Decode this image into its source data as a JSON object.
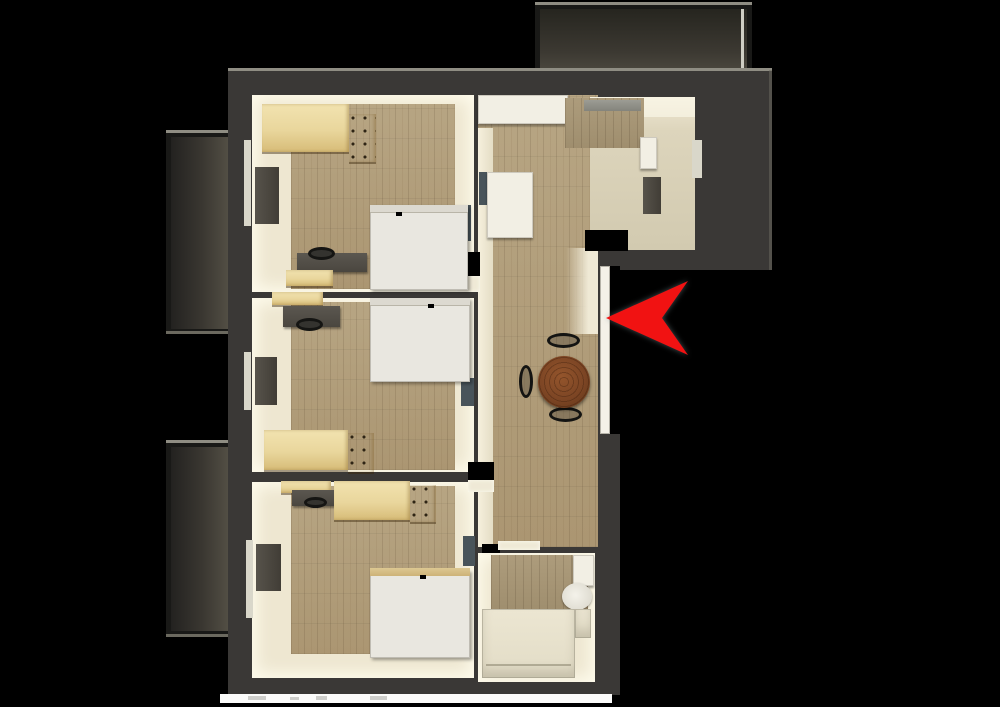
{
  "scene": {
    "view": "top-down-3d-floorplan-render",
    "background": "#000000",
    "marker": {
      "name": "entrance-arrow",
      "shape": "arrowhead-pointing-left",
      "color": "#f11212",
      "indicates": "entrance-door"
    }
  },
  "palette": {
    "wall": "#3a3836",
    "wall_edge_highlight": "#8f8d83",
    "floor_wood": "#b2a07e",
    "floor_cream": "#eee7d1",
    "floor_entry": "#d9d2b8",
    "pine_furniture": "#ecd9a2",
    "bed_white": "#e9e7e0",
    "desk_dark": "#57534b",
    "chair_black": "#141412",
    "table_brown": "#7c4524",
    "entrance_door_white": "#f4f1e8",
    "balcony_floor": "#46433b",
    "closed_door_slate": "#49545a"
  },
  "rooms": [
    {
      "id": "bedroom-top-left",
      "furniture": [
        "pine-wardrobe",
        "wall-panel-desk",
        "window",
        "white-bed",
        "desk",
        "chair",
        "pine-box"
      ]
    },
    {
      "id": "bedroom-middle-left",
      "furniture": [
        "pine-shelf",
        "desk",
        "chair",
        "white-bed",
        "wall-panel-desk",
        "window",
        "pine-wardrobe"
      ]
    },
    {
      "id": "bedroom-bottom-left",
      "furniture": [
        "pine-shelf",
        "desk",
        "chair",
        "pine-wardrobe",
        "wall-panel-desk",
        "window",
        "white-bed"
      ]
    },
    {
      "id": "kitchen-hall",
      "furniture": [
        "kitchen-counter",
        "tall-wood-cabinet",
        "vent",
        "fridge-cabinet",
        "counter-right",
        "dining-table",
        "dining-chair-top",
        "dining-chair-left",
        "dining-chair-bottom",
        "entrance-door"
      ]
    },
    {
      "id": "entry-niche",
      "furniture": [
        "dark-wall-panel",
        "wall-niche"
      ]
    },
    {
      "id": "bathroom",
      "furniture": [
        "cistern",
        "toilet",
        "shower-tray"
      ]
    }
  ],
  "balconies": {
    "count": 3,
    "positions": [
      "top-right-outside",
      "upper-left-outside",
      "lower-left-outside"
    ]
  },
  "footer": {
    "caption_strip_present": true,
    "caption_legible": false
  }
}
